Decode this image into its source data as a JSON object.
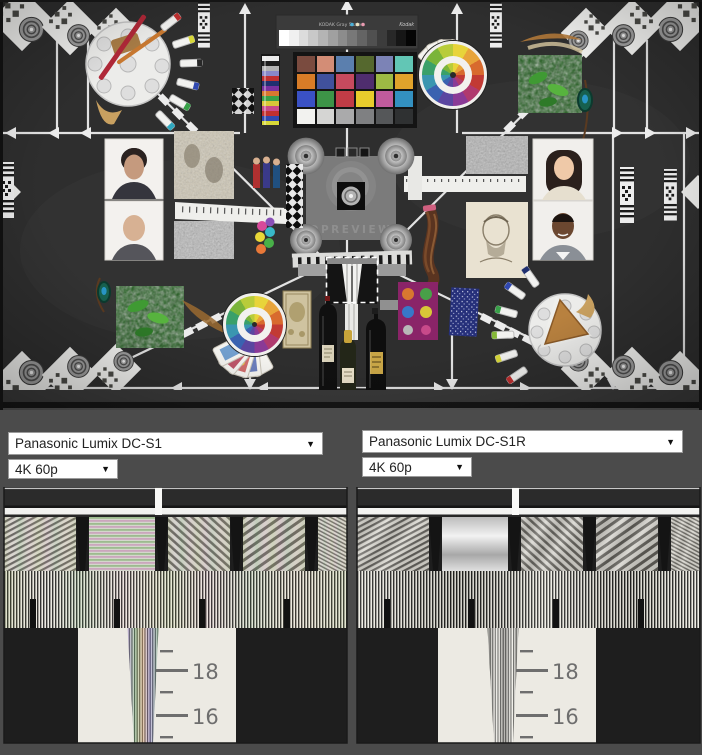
{
  "ui": {
    "dropdown_arrow": "▼",
    "background": "#4b4b4b"
  },
  "scene": {
    "kodak_label": "KODAK Gray Scale",
    "kodak_brand": "Kodak",
    "dpreview_label": "DPREVIEW",
    "gray_steps": [
      "#ffffff",
      "#f0f0f0",
      "#dcdcdc",
      "#c8c8c8",
      "#b4b4b4",
      "#a0a0a0",
      "#8c8c8c",
      "#787878",
      "#646464",
      "#505050",
      "#3c3c3c",
      "#282828",
      "#161616",
      "#050505"
    ],
    "colorchecker": [
      "#7a4b3f",
      "#d38d76",
      "#5b7fae",
      "#55682e",
      "#7c83b6",
      "#62c6b5",
      "#d87c27",
      "#40519c",
      "#c64a5e",
      "#4f2d6e",
      "#9dba44",
      "#e0a32b",
      "#3a51c4",
      "#3d9447",
      "#c13c46",
      "#e8cc2c",
      "#c05b9c",
      "#3390c0",
      "#f2f2ef",
      "#d5d5d3",
      "#aaaaab",
      "#7f8082",
      "#555759",
      "#2f3132"
    ],
    "color_wheel_hues": [
      "#e8d43a",
      "#e8a43a",
      "#d86a2e",
      "#c23a34",
      "#b03a6e",
      "#8a3a96",
      "#5a46a0",
      "#3a62b0",
      "#3a96b0",
      "#3aa06a",
      "#7ab43a",
      "#b8cc3a"
    ]
  },
  "comparisons": {
    "left": {
      "camera": "Panasonic Lumix DC-S1",
      "mode": "4K 60p",
      "wedge_scale_labels": [
        "18",
        "16"
      ]
    },
    "right": {
      "camera": "Panasonic Lumix DC-S1R",
      "mode": "4K 60p",
      "wedge_scale_labels": [
        "18",
        "16"
      ]
    }
  }
}
